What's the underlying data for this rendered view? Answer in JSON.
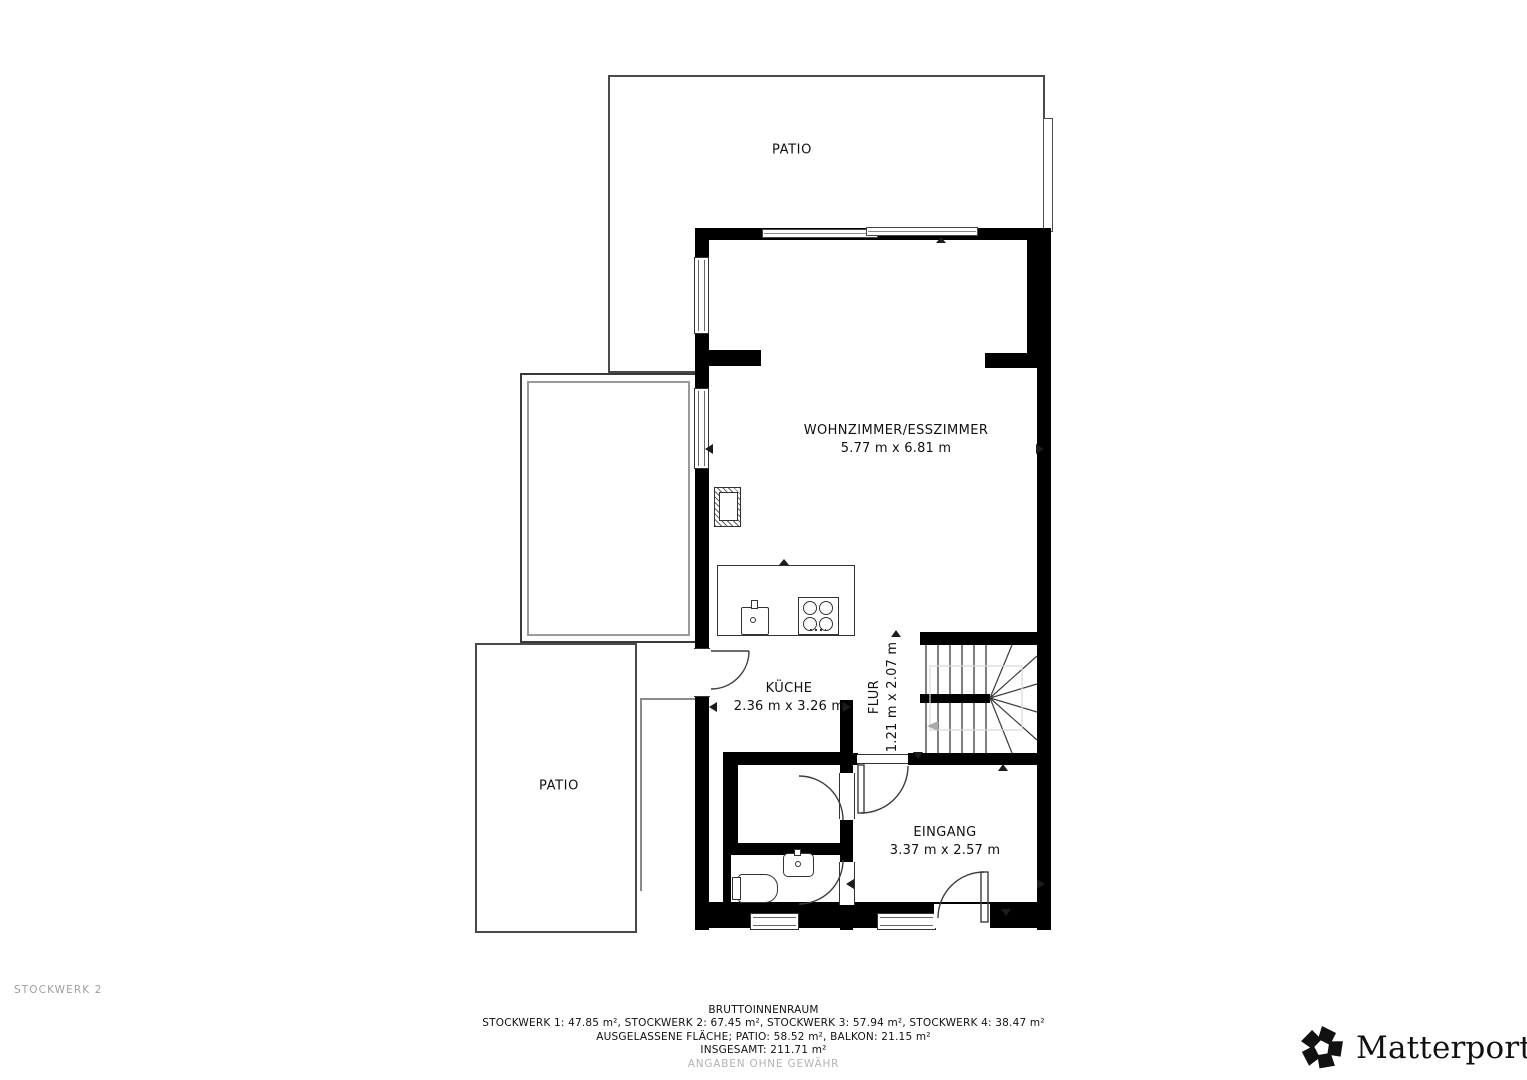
{
  "plan": {
    "level_label": "STOCKWERK 2",
    "rooms": {
      "patio_top": {
        "name": "PATIO"
      },
      "patio_left": {
        "name": "PATIO"
      },
      "living": {
        "name": "WOHNZIMMER/ESSZIMMER",
        "dims": "5.77 m x 6.81 m"
      },
      "kitchen": {
        "name": "KÜCHE",
        "dims": "2.36 m x 3.26 m"
      },
      "hall": {
        "name": "FLUR",
        "dims": "1.21 m x 2.07 m"
      },
      "entrance": {
        "name": "EINGANG",
        "dims": "3.37 m x 2.57 m"
      }
    }
  },
  "footer": {
    "title": "BRUTTOINNENRAUM",
    "floors_line": "STOCKWERK 1: 47.85 m², STOCKWERK 2: 67.45 m², STOCKWERK 3: 57.94 m², STOCKWERK 4: 38.47 m²",
    "excluded_line": "AUSGELASSENE FLÄCHE; PATIO: 58.52 m², BALKON: 21.15 m²",
    "total_line": "INSGESAMT: 211.71 m²",
    "disclaimer": "ANGABEN OHNE GEWÄHR"
  },
  "branding": {
    "logo_text": "Matterport",
    "registered": "®"
  },
  "colors": {
    "wall": "#000000",
    "line": "#3a3a3a",
    "outdoor_line": "#4a4a4a",
    "muted_line": "#9a9a9a",
    "muted_text": "#9e9e9e",
    "faint_text": "#b3b3b3"
  }
}
